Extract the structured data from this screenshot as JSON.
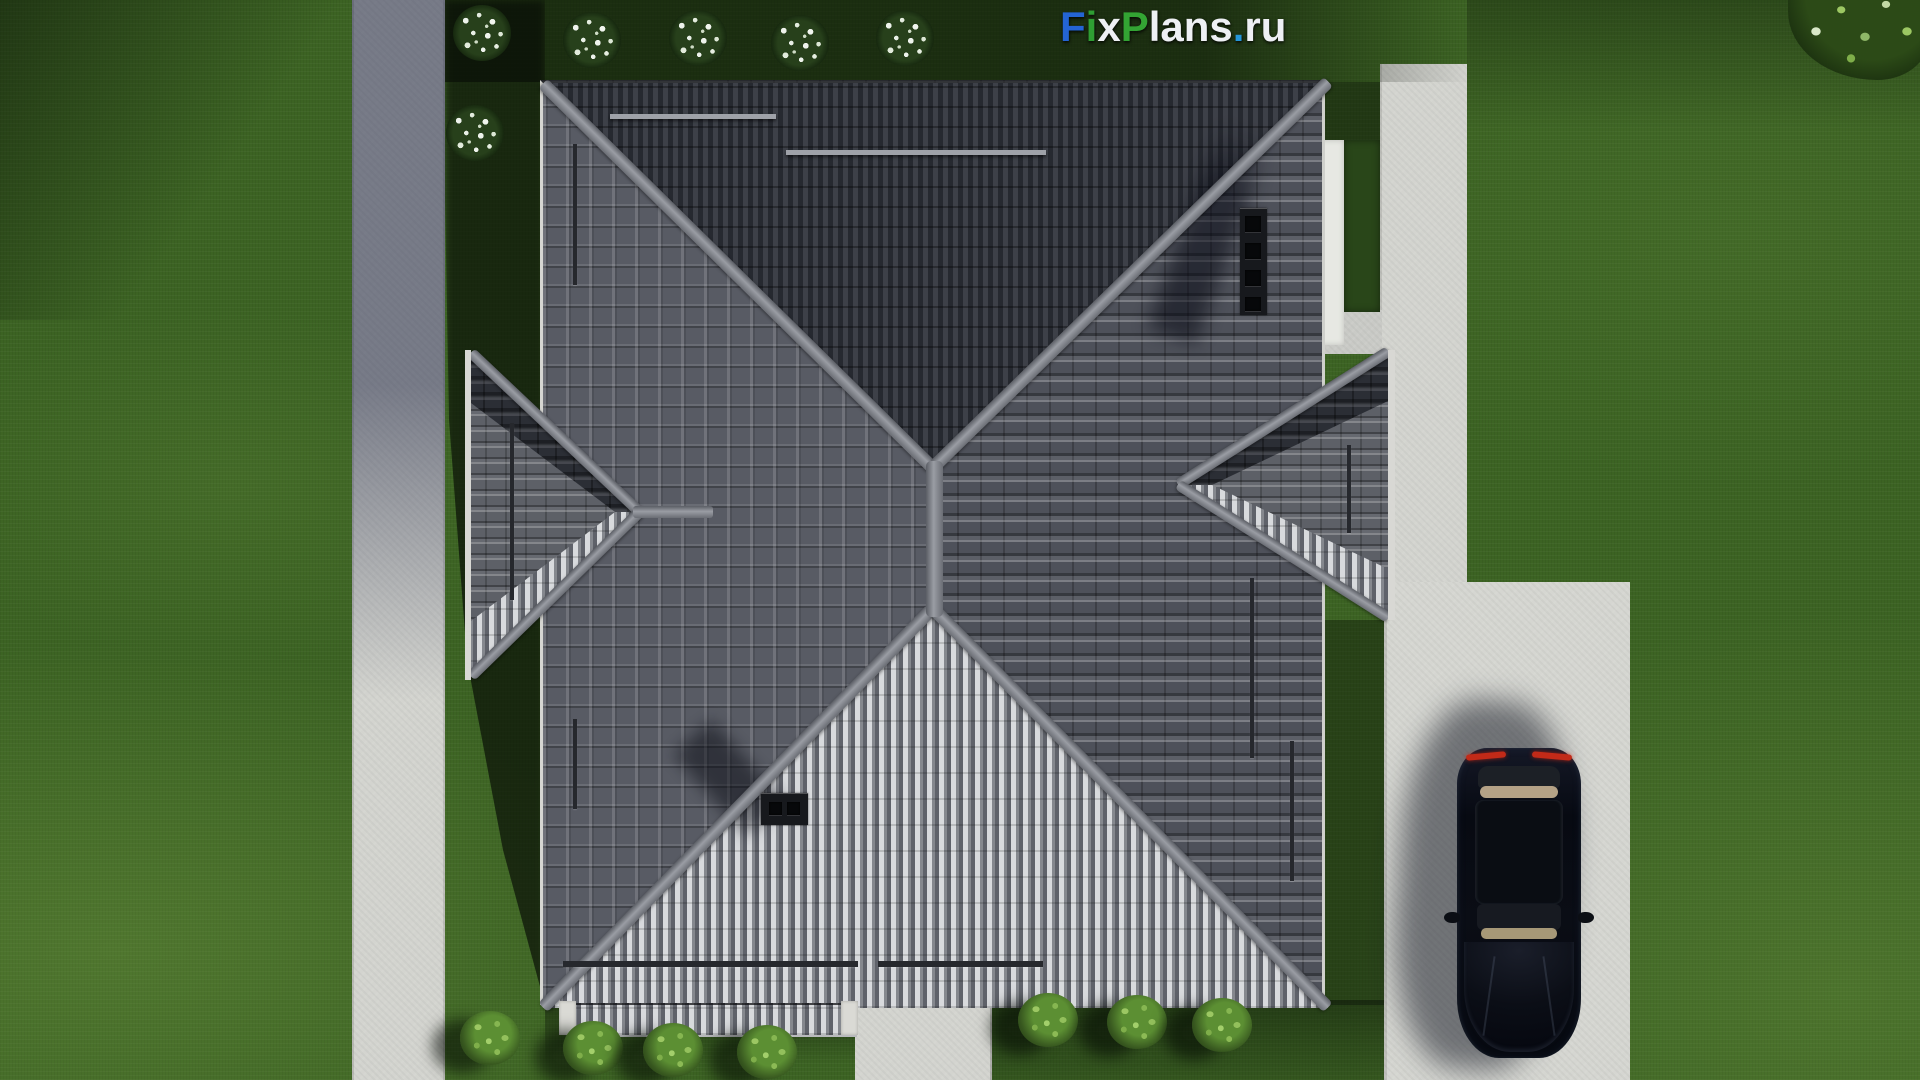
{
  "brand": {
    "text": "FixPlans.ru",
    "letters": [
      {
        "ch": "F",
        "color": "#2464d4"
      },
      {
        "ch": "i",
        "color": "#2f9e33"
      },
      {
        "ch": "x",
        "color": "#eef0f4"
      },
      {
        "ch": "P",
        "color": "#33a433"
      },
      {
        "ch": "l",
        "color": "#eef0f4"
      },
      {
        "ch": "a",
        "color": "#eef0f4"
      },
      {
        "ch": "n",
        "color": "#eef0f4"
      },
      {
        "ch": "s",
        "color": "#eef0f4"
      },
      {
        "ch": ".",
        "color": "#2596d8"
      },
      {
        "ch": "r",
        "color": "#eef0f4"
      },
      {
        "ch": "u",
        "color": "#eef0f4"
      }
    ]
  },
  "palette": {
    "grass": "#3c6323",
    "grass_shadow": "#15280f",
    "roof_dark": "#2c2f36",
    "roof_mid": "#53565e",
    "roof_bright": "#d7d8db",
    "ridge": "#8e9198",
    "pavement": "#d3d4cf",
    "pavement_shaded": "#9296ab",
    "car_body": "#0a0d15",
    "car_taillight": "#c22a18",
    "bush_white": "#e8efe6",
    "bush_green": "#5c8f33"
  }
}
